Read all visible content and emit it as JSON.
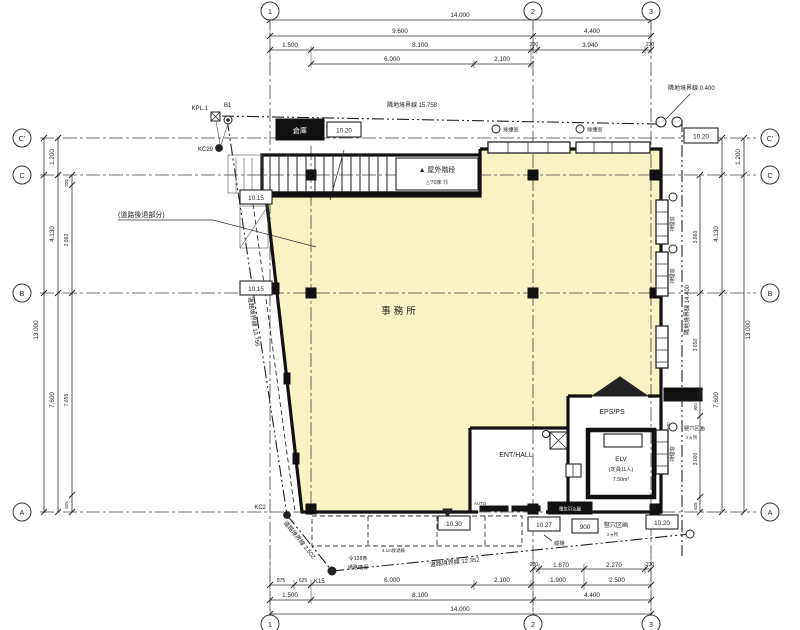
{
  "grid": {
    "cols": [
      "1",
      "2",
      "3"
    ],
    "rows": [
      "C'",
      "C",
      "B",
      "A"
    ]
  },
  "dims": {
    "top": {
      "total": "14.000",
      "row2": [
        "9.600",
        "4.400"
      ],
      "row3": [
        "1.500",
        "8.100",
        "230",
        "3.940",
        "230"
      ],
      "row4": [
        "6.000",
        "2.100"
      ]
    },
    "bottom": {
      "row1": [
        "230",
        "1.670",
        "2.270",
        "230"
      ],
      "row2": [
        "875",
        "625",
        "6.000",
        "2.100",
        "1.900",
        "2.500"
      ],
      "row3": [
        "1.500",
        "8.100",
        "4.400"
      ],
      "total": "14.000"
    },
    "left": {
      "total": "13.000",
      "chain": [
        "1.200",
        "4.130",
        "7.600"
      ],
      "inner": [
        "205",
        "2.860",
        "7.655",
        "625"
      ]
    },
    "right": {
      "total": "13.000",
      "chain": [
        "1.200",
        "4.130",
        "7.600"
      ],
      "inner": [
        "3.860",
        "3.650",
        "900",
        "3.000",
        "625"
      ],
      "extra": "940"
    }
  },
  "boundaries": {
    "top": "隣地境界線 15.758",
    "top_right": "隣地境界線 0.400",
    "right": "隣地境界線 14.400",
    "left": "道路境界線 13.756",
    "bottom": "道路境界線 12.352",
    "bottom_left": "道路境界線 3.502"
  },
  "points": {
    "kpl1": "KPL.1",
    "b1": "B1",
    "kc29": "KC29",
    "kc2": "KC2",
    "k15": "K15"
  },
  "rooms": {
    "office": "事務所",
    "ent_hall": "ENT/HALL",
    "eps_ps": "EPS/PS",
    "elv1": "ELV",
    "elv2": "(定員11人)",
    "elv3": "7.50m²",
    "storage": "倉庫"
  },
  "stair": {
    "main": "▲ 屋外階段",
    "sub": "△'70床 ⑮"
  },
  "levels": {
    "top_left": "10.20",
    "top_right": "10.20",
    "left1": "10.15",
    "left2": "10.15",
    "bottom1": "10.30",
    "bottom2": "10.27",
    "bottom3": "10.20",
    "box900": "900"
  },
  "notes": {
    "setback": "(道路後退部分)",
    "ord1": "令128条",
    "ord2": "通路確保",
    "setback2": "4.1m後退線",
    "shaft": "竪穴区画",
    "shaft_sub": "2ヵ所",
    "downpipe": "縦樋",
    "elec": "電気引込盤",
    "auto": "AUTO",
    "smoke": "排煙窓"
  }
}
